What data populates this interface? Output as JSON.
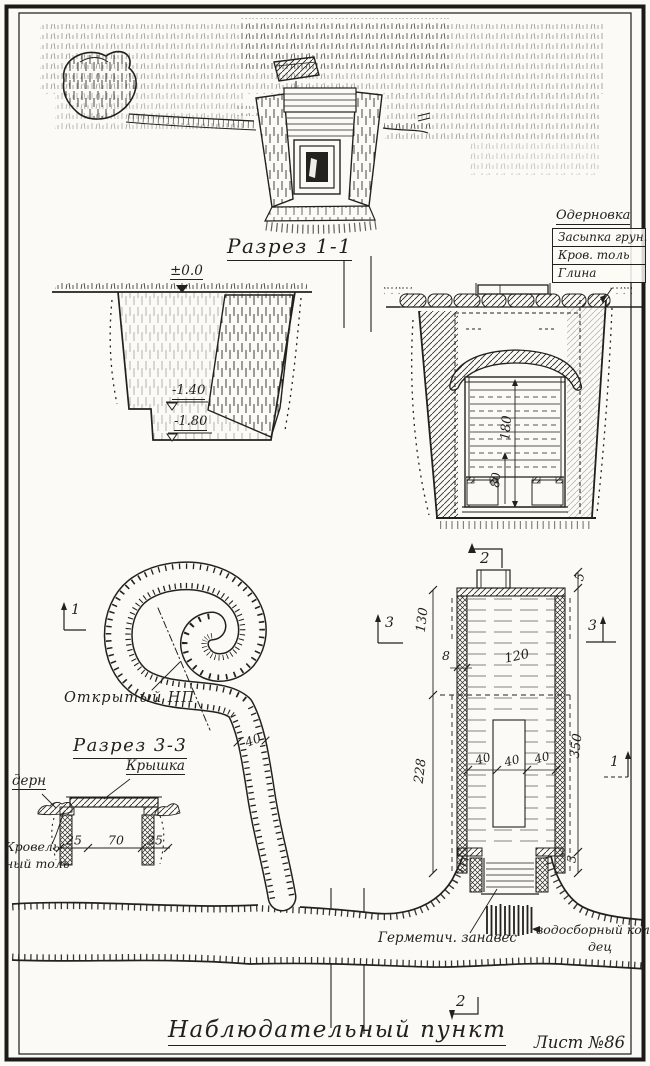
{
  "sheet": {
    "main_title": "Наблюдательный пункт",
    "sheet_number": "Лист №86"
  },
  "section_1_1": {
    "title": "Разрез 1-1",
    "elev_zero": "±0.0",
    "elev_mid": "-1.40",
    "elev_deep": "-1.80",
    "dim_interior_height": "180",
    "dim_bench_height": "80",
    "marker_2": "2",
    "layer_callout": {
      "top": "Одерновка",
      "row_1": "Засыпка грун.",
      "row_2": "Кров. толь",
      "row_3": "Глина"
    }
  },
  "plan": {
    "dim_130": "130",
    "dim_228": "228",
    "dim_8": "8",
    "dim_120": "120",
    "dim_40_1": "40",
    "dim_40_2": "40",
    "dim_40_3": "40",
    "dim_350": "350",
    "dim_5": "5",
    "dim_3": "3",
    "marker_3_left": "3",
    "marker_3_right": "3",
    "marker_1_left": "1",
    "marker_1_right": "1",
    "marker_2_bottom": "2",
    "label_curtain": "Герметич. занавес",
    "label_well_line1": "водосборный коло-",
    "label_well_line2": "дец"
  },
  "open_np": {
    "label": "Открытый НП",
    "dim_width": "40"
  },
  "section_3_3": {
    "title": "Разрез 3-3",
    "label_cover": "Крышка",
    "label_turf": "дерн",
    "label_felt_line1": "Кровель-",
    "label_felt_line2": "ный толь",
    "dim_25_left": "25",
    "dim_70": "70",
    "dim_25_right": "25"
  }
}
